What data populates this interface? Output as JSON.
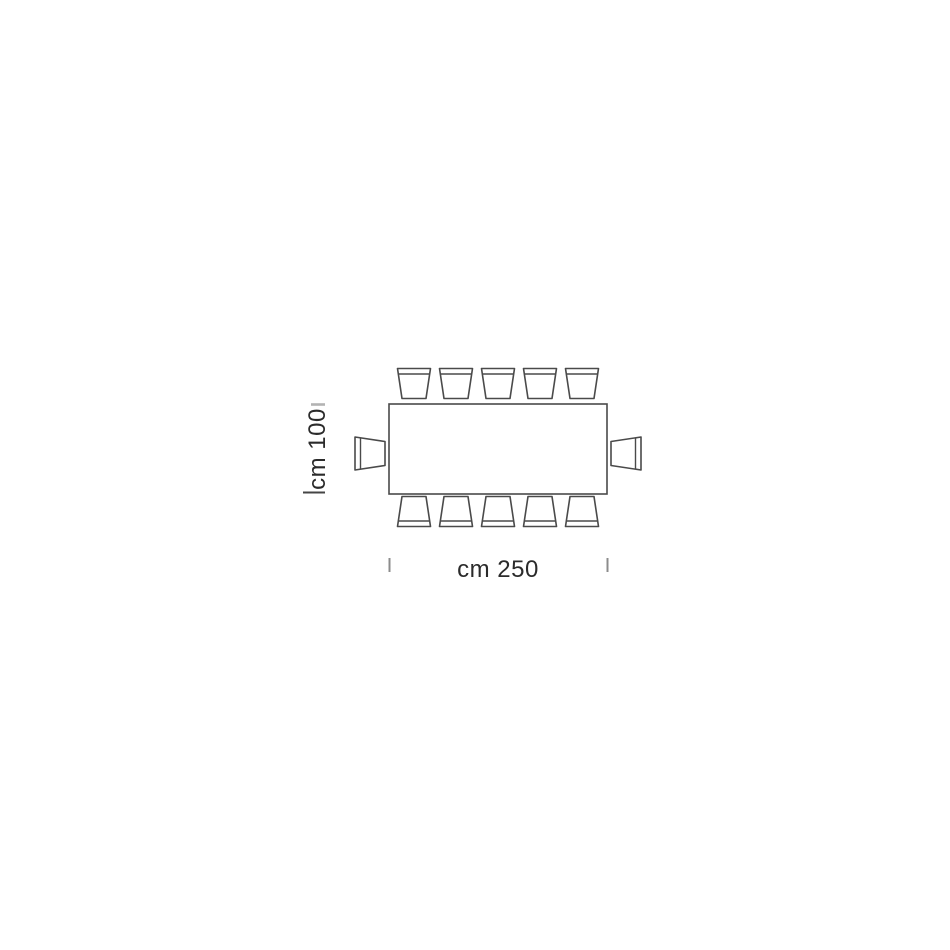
{
  "diagram": {
    "type": "furniture-plan-top-view",
    "subject": "rectangular dining table with seating",
    "width_label": "cm 250",
    "height_label": "cm 100",
    "table": {
      "shape": "rectangle",
      "width_cm": 250,
      "depth_cm": 100
    },
    "seats": {
      "top": 5,
      "bottom": 5,
      "left_end": 1,
      "right_end": 1,
      "total": 12
    },
    "colors": {
      "line": "#4a4a4a",
      "fill": "#ffffff",
      "tick_light": "#b3b3b3",
      "tick_dark": "#454545",
      "tick_gray": "#8c8c8c",
      "text": "#2b2b2b",
      "background": "#ffffff"
    }
  }
}
